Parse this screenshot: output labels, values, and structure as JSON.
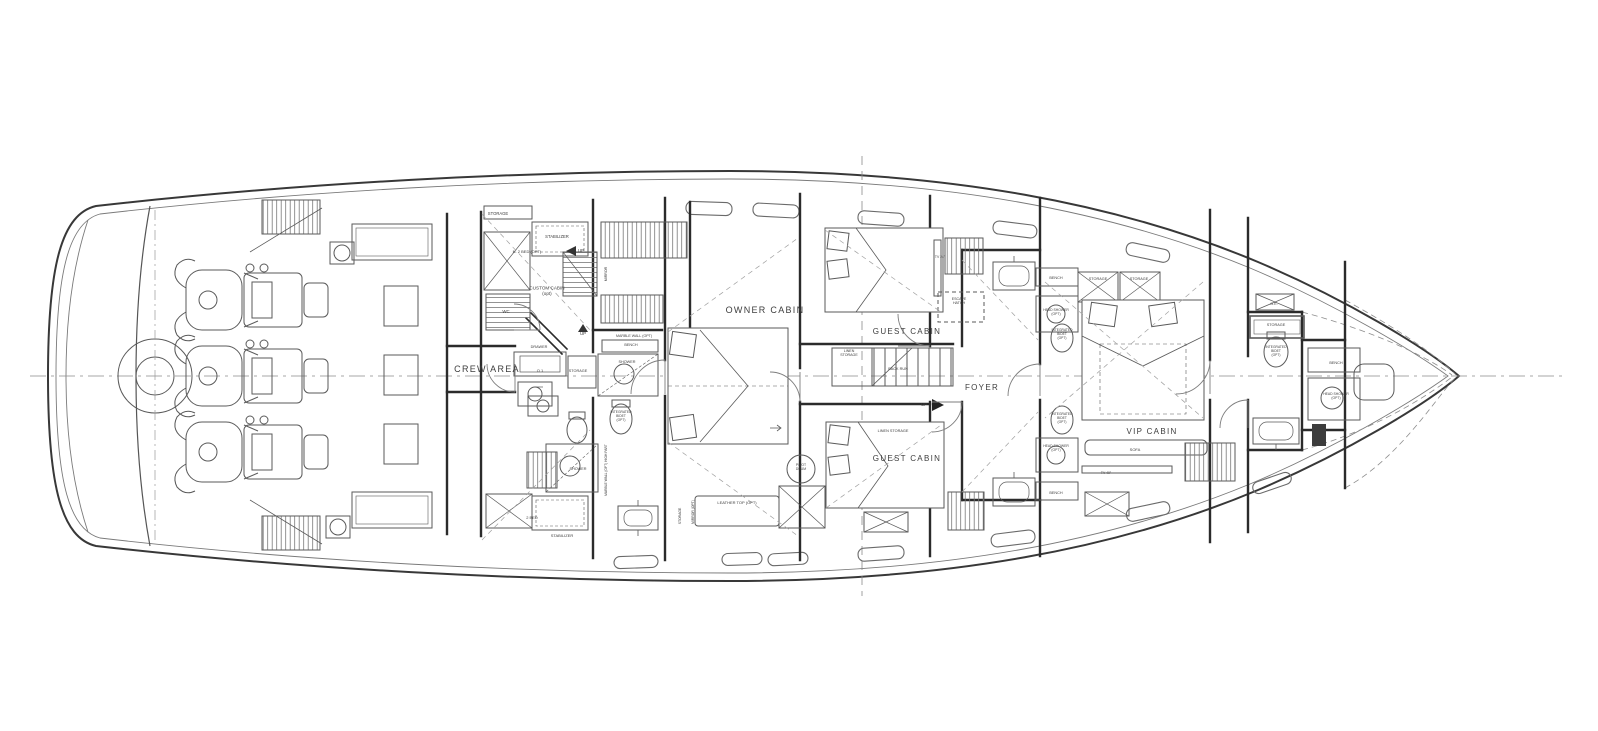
{
  "diagram": {
    "type": "yacht-lower-deck-floor-plan",
    "description": "Lower deck general arrangement plan of a motor yacht: engine room aft (left), crew area, owner cabin amidships, two guest cabins, foyer, VIP cabin forward, bow head",
    "line_color": "#3a3a3a",
    "background": "#ffffff"
  },
  "labels": [
    {
      "name": "room-crew-area",
      "text": "CREW AREA",
      "x": 487,
      "y": 372,
      "size": 9,
      "ls": 1.1,
      "room": true
    },
    {
      "name": "room-owner-cabin",
      "text": "OWNER CABIN",
      "x": 765,
      "y": 313,
      "size": 9,
      "ls": 1.3,
      "room": true
    },
    {
      "name": "room-guest-cabin-upper",
      "text": "GUEST CABIN",
      "x": 907,
      "y": 334,
      "size": 8,
      "ls": 1.1,
      "room": true
    },
    {
      "name": "room-guest-cabin-lower",
      "text": "GUEST CABIN",
      "x": 907,
      "y": 461,
      "size": 8,
      "ls": 1.1,
      "room": true
    },
    {
      "name": "room-foyer",
      "text": "FOYER",
      "x": 982,
      "y": 390,
      "size": 8,
      "ls": 1.1,
      "room": true
    },
    {
      "name": "room-vip-cabin",
      "text": "VIP CABIN",
      "x": 1152,
      "y": 434,
      "size": 8,
      "ls": 1.1,
      "room": true
    },
    {
      "name": "ann-custom-cabin",
      "lines": [
        "CUSTOM CABIN",
        "(opt)"
      ],
      "x": 547,
      "y": 292,
      "size": 4.6,
      "lh": 5.5
    },
    {
      "name": "ann-storage-crew-top",
      "text": "STORAGE",
      "x": 498,
      "y": 215,
      "size": 4.2
    },
    {
      "name": "ann-stabilizer-top",
      "text": "STABILIZER",
      "x": 557,
      "y": 238,
      "size": 4.2
    },
    {
      "name": "ann-n2-bed-opt",
      "text": "N. 2 BED (OPT)",
      "x": 527,
      "y": 253,
      "size": 4.0
    },
    {
      "name": "ann-up-crew-top",
      "text": "UP",
      "x": 581,
      "y": 252,
      "size": 4.4
    },
    {
      "name": "ann-wc",
      "text": "WC",
      "x": 506,
      "y": 313,
      "size": 4.4
    },
    {
      "name": "ann-up-crew-mid",
      "text": "UP",
      "x": 583,
      "y": 335,
      "size": 4.4
    },
    {
      "name": "ann-drawer",
      "text": "DRAWER",
      "x": 539,
      "y": 348,
      "size": 3.8
    },
    {
      "name": "ann-o1",
      "text": "O 1",
      "x": 540,
      "y": 372,
      "size": 4.0
    },
    {
      "name": "ann-storage-crew-mid",
      "text": "STORAGE",
      "x": 578,
      "y": 372,
      "size": 3.8
    },
    {
      "name": "ann-mirror-vert",
      "text": "MIRROR",
      "x": 607,
      "y": 274,
      "size": 3.6,
      "rot": -90
    },
    {
      "name": "ann-marble-wall-opt",
      "text": "MARBLE WALL (OPT)",
      "x": 634,
      "y": 337,
      "size": 3.6
    },
    {
      "name": "ann-bench-owner",
      "text": "BENCH",
      "x": 631,
      "y": 346,
      "size": 3.8
    },
    {
      "name": "ann-shower-owner",
      "text": "SHOWER",
      "x": 627,
      "y": 363,
      "size": 3.8
    },
    {
      "name": "ann-bidet-owner",
      "lines": [
        "INTEGRATED",
        "BIDET",
        "(OPT)"
      ],
      "x": 621,
      "y": 417,
      "size": 3.3,
      "lh": 4
    },
    {
      "name": "ann-marble-wall-high",
      "text": "MARBLE WALL (OPT) HIGH PART",
      "x": 607,
      "y": 470,
      "size": 3.3,
      "rot": -90
    },
    {
      "name": "ann-shower-crew",
      "text": "SHOWER",
      "x": 578,
      "y": 470,
      "size": 3.8
    },
    {
      "name": "ann-2-bed",
      "text": "2 BED",
      "x": 532,
      "y": 519,
      "size": 4.0
    },
    {
      "name": "ann-stabilizer-bottom",
      "text": "STABILIZER",
      "x": 562,
      "y": 537,
      "size": 4.0
    },
    {
      "name": "ann-leather-top",
      "text": "LEATHER TOP (OPT)",
      "x": 737,
      "y": 504,
      "size": 4.0
    },
    {
      "name": "ann-pivot-drum",
      "lines": [
        "PIVOT",
        "DRUM"
      ],
      "x": 801,
      "y": 468,
      "size": 3.4,
      "lh": 4
    },
    {
      "name": "ann-mirror-opt-vert",
      "text": "MIRROR (OPT)",
      "x": 694,
      "y": 512,
      "size": 3.4,
      "rot": -90
    },
    {
      "name": "ann-storage-vert",
      "text": "STORAGE",
      "x": 681,
      "y": 516,
      "size": 3.4,
      "rot": -90
    },
    {
      "name": "ann-linen-storage-upper",
      "lines": [
        "LINEN",
        "STORAGE"
      ],
      "x": 849,
      "y": 354,
      "size": 3.6,
      "lh": 4.4
    },
    {
      "name": "ann-back-run",
      "text": "BACK RUN",
      "x": 898,
      "y": 370,
      "size": 3.8
    },
    {
      "name": "ann-up-foyer",
      "text": "UP",
      "x": 924,
      "y": 406,
      "size": 4.4
    },
    {
      "name": "ann-linen-storage-lower",
      "text": "LINEN STORAGE",
      "x": 893,
      "y": 432,
      "size": 3.8
    },
    {
      "name": "ann-tv24",
      "text": "TV 24\"",
      "x": 940,
      "y": 258,
      "size": 3.4
    },
    {
      "name": "ann-escape-hatch",
      "lines": [
        "ESCAPE",
        "HATCH"
      ],
      "x": 959,
      "y": 302,
      "size": 3.6,
      "lh": 4.4
    },
    {
      "name": "ann-bench-upper",
      "text": "BENCH",
      "x": 1056,
      "y": 279,
      "size": 3.8
    },
    {
      "name": "ann-head-shower-upper",
      "lines": [
        "HEAD SHOWER",
        "(OPT)"
      ],
      "x": 1056,
      "y": 313,
      "size": 3.4,
      "lh": 4
    },
    {
      "name": "ann-bidet-upper",
      "lines": [
        "INTEGRATED",
        "BIDET",
        "(OPT)"
      ],
      "x": 1062,
      "y": 335,
      "size": 3.3,
      "lh": 4
    },
    {
      "name": "ann-storage-vip-1",
      "text": "STORAGE",
      "x": 1098,
      "y": 280,
      "size": 3.8
    },
    {
      "name": "ann-storage-vip-2",
      "text": "STORAGE",
      "x": 1139,
      "y": 280,
      "size": 3.8
    },
    {
      "name": "ann-bidet-lower",
      "lines": [
        "INTEGRATED",
        "BIDET",
        "(OPT)"
      ],
      "x": 1062,
      "y": 419,
      "size": 3.3,
      "lh": 4
    },
    {
      "name": "ann-head-shower-lower",
      "lines": [
        "HEAD SHOWER",
        "(OPT)"
      ],
      "x": 1056,
      "y": 449,
      "size": 3.4,
      "lh": 4
    },
    {
      "name": "ann-bench-lower",
      "text": "BENCH",
      "x": 1056,
      "y": 494,
      "size": 3.8
    },
    {
      "name": "ann-sofa",
      "text": "SOFA",
      "x": 1135,
      "y": 451,
      "size": 4.0
    },
    {
      "name": "ann-tv40",
      "text": "TV 40\"",
      "x": 1106,
      "y": 474,
      "size": 3.4
    },
    {
      "name": "ann-ge",
      "text": "G.E.",
      "x": 1274,
      "y": 305,
      "size": 3.8
    },
    {
      "name": "ann-storage-fwd",
      "text": "STORAGE",
      "x": 1276,
      "y": 326,
      "size": 3.8
    },
    {
      "name": "ann-bidet-fwd",
      "lines": [
        "INTEGRATED",
        "BIDET",
        "(OPT)"
      ],
      "x": 1276,
      "y": 352,
      "size": 3.3,
      "lh": 4
    },
    {
      "name": "ann-bench-fwd",
      "text": "BENCH",
      "x": 1336,
      "y": 364,
      "size": 3.8
    },
    {
      "name": "ann-head-shower-fwd",
      "lines": [
        "HEAD SHOWER",
        "(OPT)"
      ],
      "x": 1336,
      "y": 397,
      "size": 3.4,
      "lh": 4
    }
  ]
}
